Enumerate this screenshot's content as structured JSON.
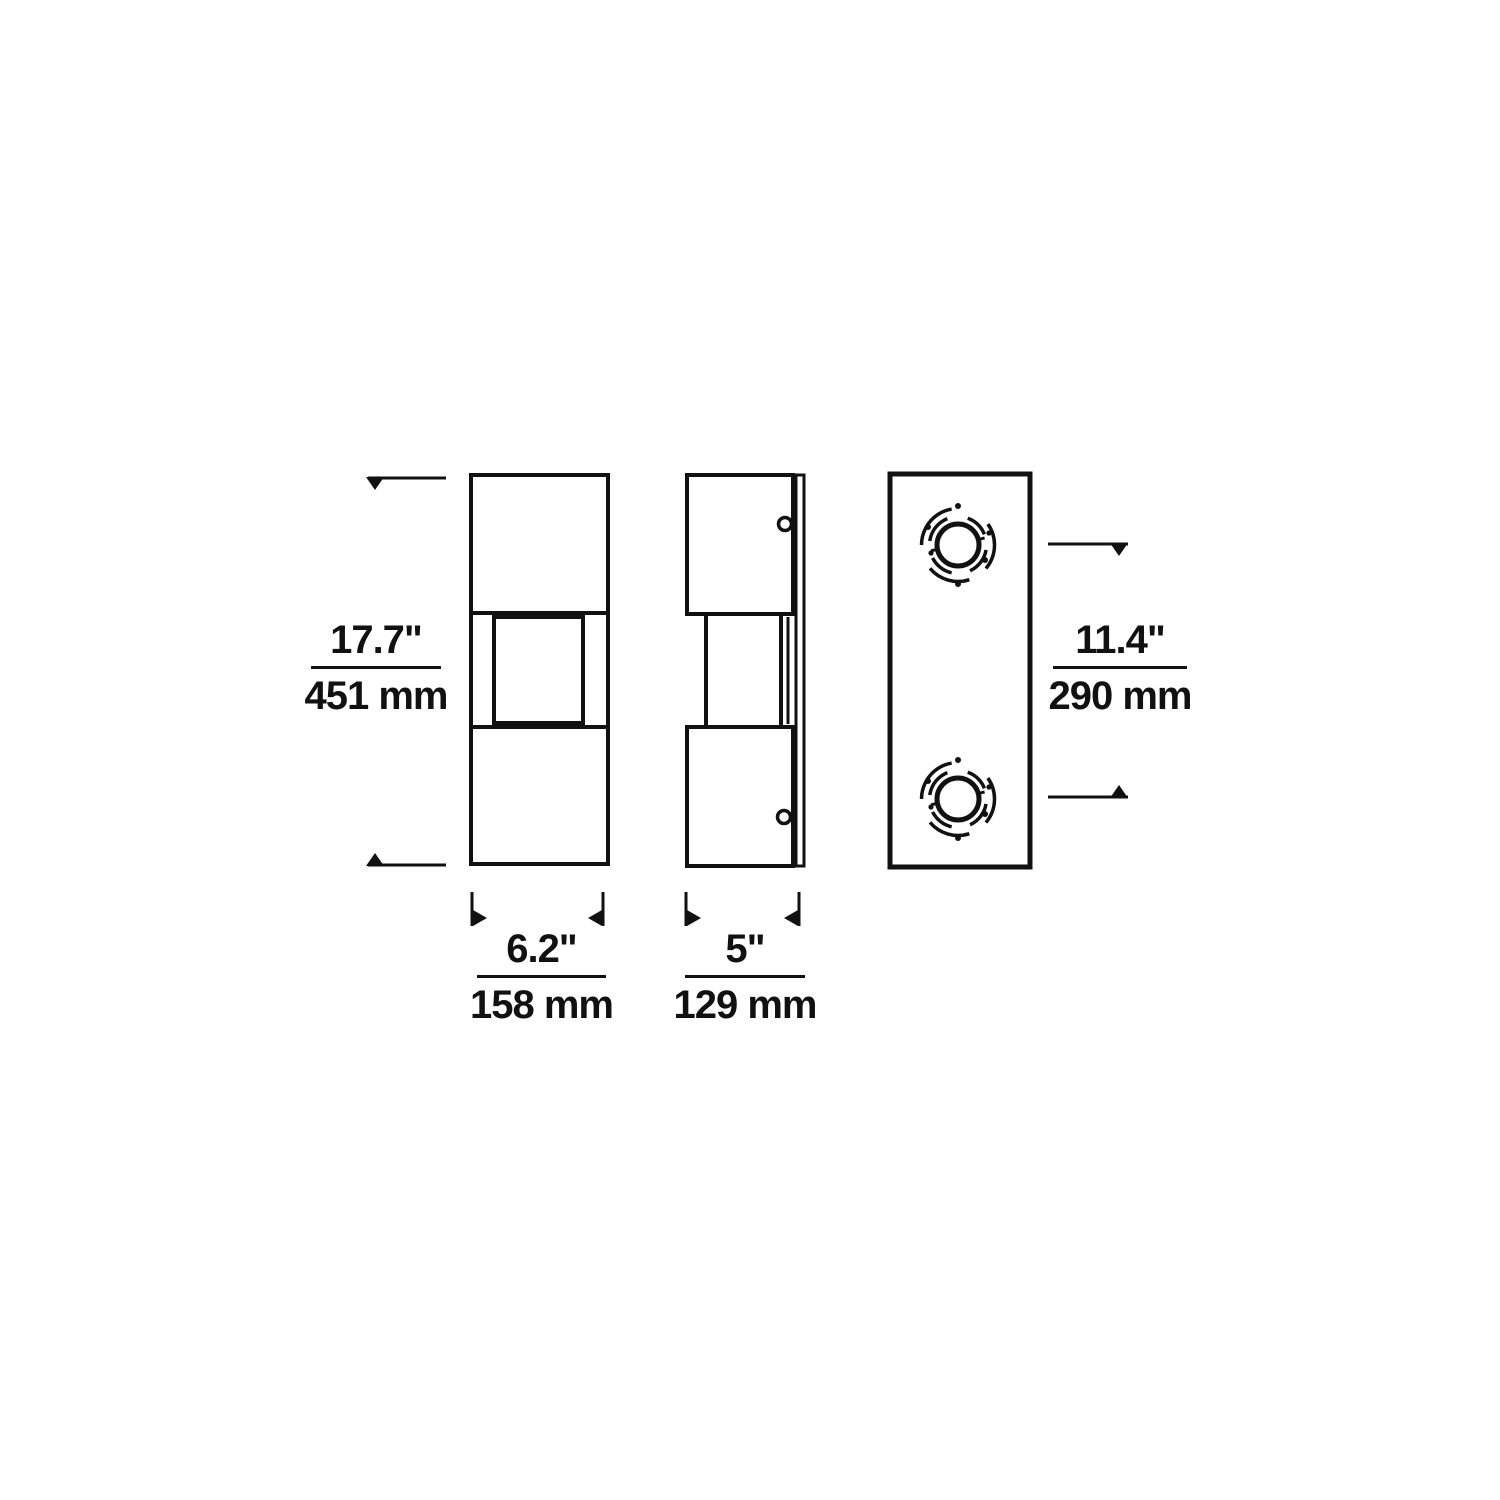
{
  "dims": {
    "height": {
      "inches": "17.7\"",
      "mm": "451 mm"
    },
    "mount": {
      "inches": "11.4\"",
      "mm": "290 mm"
    },
    "width": {
      "inches": "6.2\"",
      "mm": "158 mm"
    },
    "depth": {
      "inches": "5\"",
      "mm": "129 mm"
    }
  },
  "colors": {
    "line": "#111111",
    "background": "#ffffff"
  }
}
